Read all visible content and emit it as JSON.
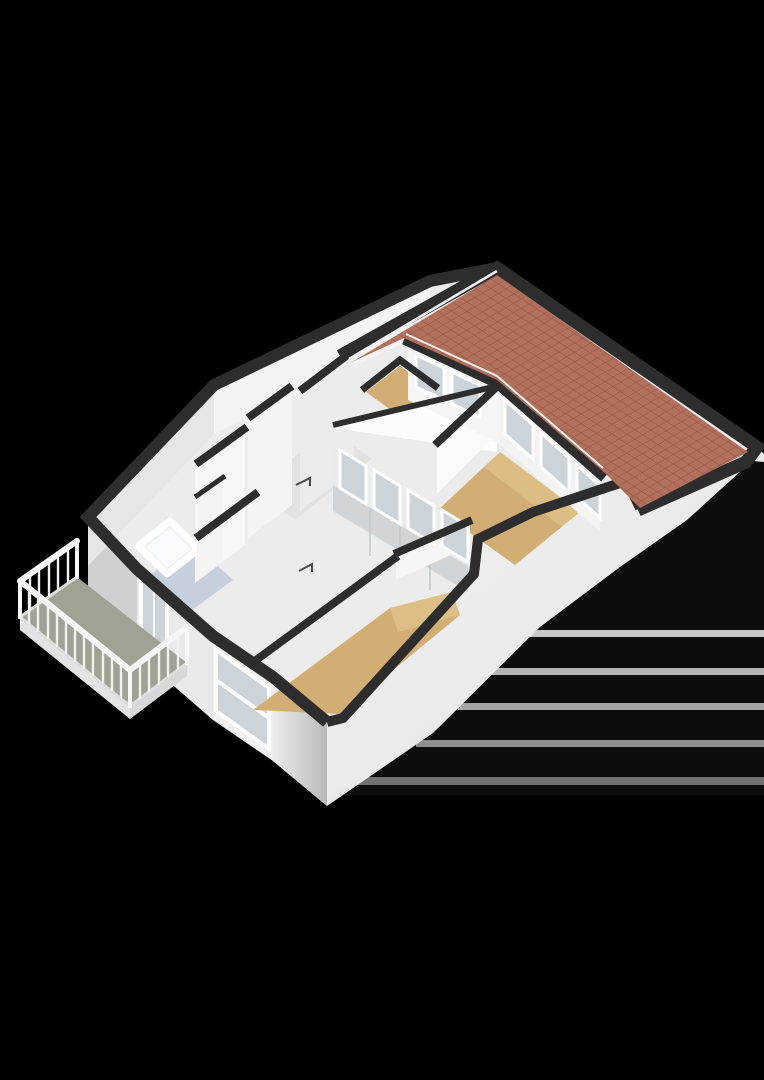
{
  "scene": {
    "kind": "3d-floorplan-render",
    "view": "isometric-cutaway",
    "storey": "upper-floor",
    "rooms": [
      "bedroom-main",
      "bedroom-right",
      "room-top-small",
      "room-top-left",
      "bathroom",
      "hallway",
      "balcony",
      "roofed-attic"
    ],
    "features": [
      "tiled-pitched-roof",
      "balcony-with-white-railing",
      "bathtub",
      "sliding-glass-door",
      "clerestory-window-band",
      "facade-window",
      "door-swing-marks",
      "ground-shadow-bands"
    ]
  },
  "colors": {
    "background": "#000000",
    "wall_cap": "#2d2d2d",
    "wall_white": "#f4f4f4",
    "wall_light": "#eaeaea",
    "wall_shade": "#d2d5d7",
    "wall_west": "#d0d0d0",
    "skirt": "#efefef",
    "base": "#ececec",
    "floor_wood": "#d2ae74",
    "floor_wood_light": "#e6cd96",
    "floor_bath": "#c6d0dd",
    "floor_hall": "#e2e2e2",
    "floor_balcony": "#a0a294",
    "railing": "#f6f6f6",
    "roof_tile": "#b3705c",
    "roof_grid": "#8f5340",
    "glass": "#ccd3d9",
    "window_frame": "#ffffff",
    "tub_fill": "#eef2f4",
    "shadow_band_1": "#c7c7c7",
    "shadow_band_2": "#b6b6b6",
    "shadow_band_3": "#a4a4a4",
    "shadow_band_4": "#8e8e8e",
    "shadow_band_5": "#717171"
  }
}
